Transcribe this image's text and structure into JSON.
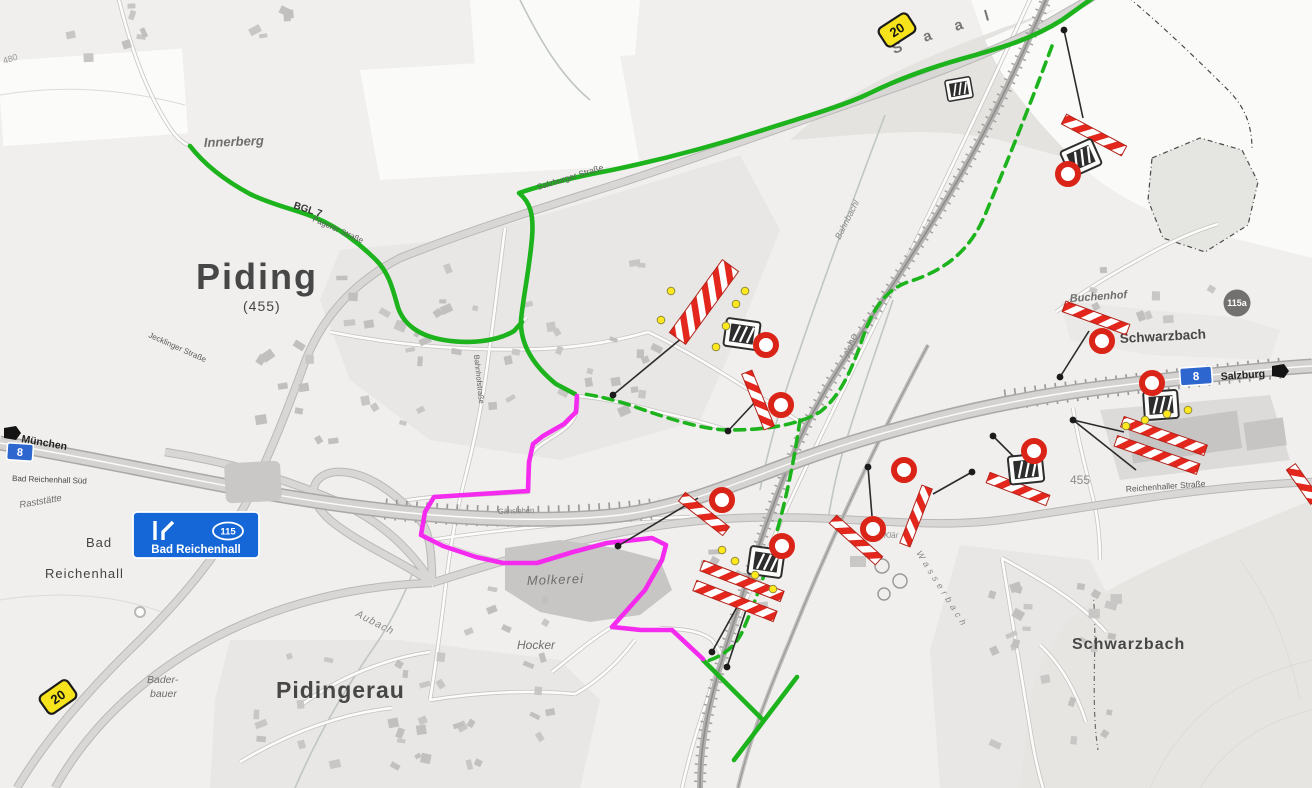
{
  "map": {
    "towns": {
      "piding": "Piding",
      "piding_elevation": "(455)",
      "pidingerau": "Pidingerau",
      "bad_reichenhall_line1": "Bad",
      "bad_reichenhall_line2": "Reichenhall",
      "schwarzbach_north": "Schwarzbach",
      "schwarzbach_south": "Schwarzbach"
    },
    "places": {
      "innerberg": "Innerberg",
      "buchenhof": "Buchenhof",
      "baderbauer_line1": "Bader-",
      "baderbauer_line2": "bauer",
      "molkerei": "Molkerei",
      "hocker": "Hocker",
      "gaenslehen": "Gänslehen",
      "klaeranlage": "Klär",
      "raststaette": "Raststätte"
    },
    "waters": {
      "saalach_letters": [
        "S",
        "a",
        "a",
        "l"
      ],
      "aubach": "Aubach",
      "bahnbachl": "Bahnbachl",
      "ache": "Ache",
      "wasserbach": "Wasserbach"
    },
    "streets": {
      "salzburger": "Salzburger Straße",
      "reichenhaller": "Reichenhaller Straße",
      "jecklinger": "Jecklinger Straße",
      "pagerer": "Pagerer Straße",
      "bahnhof": "Bahnhofstraße",
      "bgl7": "BGL 7"
    },
    "elevations": {
      "e455": "455",
      "e480": "480"
    },
    "directions": {
      "muenchen": "München",
      "salzburg": "Salzburg"
    },
    "motorway": {
      "exit_label": "Bad Reichenhall Süd"
    },
    "shields": {
      "a8": "8",
      "b20": "20",
      "st115": "115",
      "st115a": "115a"
    },
    "exit_panel": {
      "number": "115",
      "destination": "Bad Reichenhall"
    },
    "routes": {
      "detour_color": "#1db31d",
      "detour_main_style": "solid",
      "detour_alt_style": "dashed",
      "closure_access_color": "#f42bee"
    },
    "closure_markers": {
      "barrier_red": "#e3271d",
      "no_entry_ring": "#da2418",
      "warning_lamp": "#ffe81d",
      "no_entry_count": 10,
      "barrier_count": 13,
      "board_count": 6,
      "location_dot_count": 11
    }
  }
}
